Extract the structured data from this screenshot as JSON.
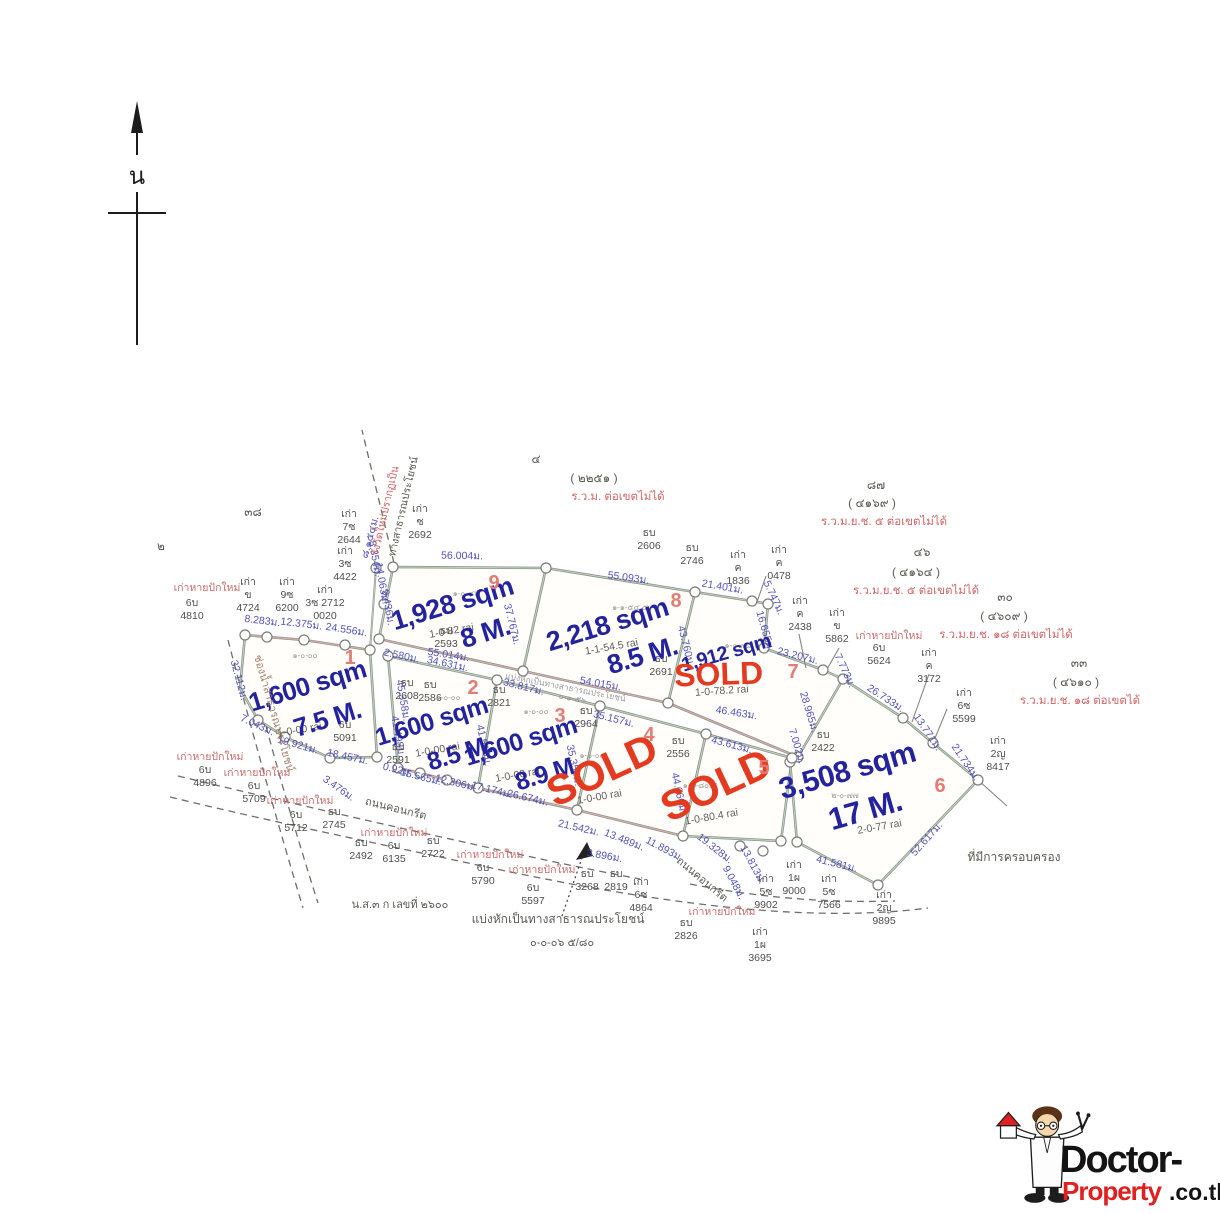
{
  "misc": {
    "compass": "น",
    "relost": "เก่าหายปักใหม่",
    "road": "ถนนคอนกรีต",
    "water": "ช่องน้ำสาธารณประโยชน์",
    "resurvey_red": "รังวัดใหม่ปรากฏเป็น",
    "resurvey_black": "ทางสาธารณประโยชน์",
    "possession": "ที่มีการครอบครอง",
    "doc": "น.ส.๓ ก เลขที่ ๒๖๐๐",
    "divide1": "แบ่งหักเป็นทางสาธารณประโยชน์",
    "divide2": "๐-๐-๐๖ ๕/๘๐",
    "road_divide": "แบ่งหักเป็นทางสาธารณประโยชน์",
    "road_divide2": "๐-๑-๕๖",
    "n38": "๓๘",
    "n2": "๒"
  },
  "colors": {
    "accent_blue": "#23239d",
    "sold_red": "#e43a20",
    "note_red": "#cf6565",
    "plot_line_green": "#b9d6ba"
  },
  "plots": [
    {
      "num": "1",
      "size": "1,600 sqm",
      "price": "7.5 M.",
      "thai": "๑-๐-๐๐",
      "rai": "1-0-00 rai"
    },
    {
      "num": "2",
      "size": "1,600 sqm",
      "price": "8.5 M.",
      "thai": "๑-๐-๐๐",
      "rai": "1-0-00 rai"
    },
    {
      "num": "3",
      "size": "1,600 sqm",
      "price": "8.9 M.",
      "thai": "๑-๐-๐๐",
      "rai": "1-0-00 rai"
    },
    {
      "num": "4",
      "sold": "SOLD",
      "thai": "๑-๐-๐๐",
      "rai": "1-0-00 rai"
    },
    {
      "num": "5",
      "sold": "SOLD",
      "thai": "๑-๐-๘๐.๔",
      "rai": "1-0-80.4 rai"
    },
    {
      "num": "6",
      "size": "3,508 sqm",
      "price": "17 M.",
      "thai": "๒-๐-๗๗",
      "rai": "2-0-77 rai"
    },
    {
      "num": "7",
      "size": "1,912 sqm",
      "sold": "SOLD",
      "thai": "๑-๐-๗๘.๒",
      "rai": "1-0-78.2 rai"
    },
    {
      "num": "8",
      "size": "2,218 sqm",
      "price": "8.5 M.",
      "thai": "๑-๑-๕๔.๕",
      "rai": "1-1-54.5 rai"
    },
    {
      "num": "9",
      "size": "1,928 sqm",
      "price": "8 M.",
      "thai": "๑-๐-๘๒",
      "rai": "1-0-82 rai"
    }
  ],
  "edges": [
    "56.004ม.",
    "55.093ม.",
    "21.401ม.",
    "5.747ม.",
    "16.655ม.",
    "23.207ม.",
    "7.773ม.",
    "26.733ม.",
    "13.771ม.",
    "21.734ม.",
    "52.617ม.",
    "41.581ม.",
    "9.048ม.",
    "13.813ม.",
    "19.328ม.",
    "11.893ม.",
    "13.489ม.",
    "21.542ม.",
    "3.896ม.",
    "46.463ม.",
    "28.965ม.",
    "7.002ม.",
    "43.613ม.",
    "44.666ม.",
    "35.157ม.",
    "35.354ม.",
    "33.817ม.",
    "41.510ม.",
    "26.674ม.",
    "17.174ม.",
    "12.306ม.",
    "15.565ม.",
    "0.92ม.",
    "18.457ม.",
    "19.921ม.",
    "7.043ม.",
    "32.112ม.",
    "8.283ม.",
    "12.375ม.",
    "24.556ม.",
    "34.631ม.",
    "2.580ม.",
    "45.358ม.",
    "41.498ม.",
    "9.436ม.",
    "14.063ม.",
    "8.354ม.",
    "54.015ม.",
    "55.014ม.",
    "37.767ม.",
    "43.760ม.",
    "3.476ม.",
    "๘.๑๕๔ม."
  ],
  "markers": [
    [
      "เก่า",
      "7ซ",
      "2644"
    ],
    [
      "เก่า",
      "ซ",
      "2692"
    ],
    [
      "เก่า",
      "3ซ",
      "4422"
    ],
    [
      "เก่า",
      "ข",
      "4724"
    ],
    [
      "เก่า",
      "9ซ",
      "6200"
    ],
    [
      "เก่า",
      "3ซ 2712",
      "0020"
    ],
    [
      "ธบ",
      "2606"
    ],
    [
      "ธบ",
      "2746"
    ],
    [
      "เก่า",
      "ค",
      "1836"
    ],
    [
      "เก่า",
      "ค",
      "0478"
    ],
    [
      "เก่า",
      "ค",
      "2438"
    ],
    [
      "เก่า",
      "ข",
      "5862"
    ],
    [
      "6บ",
      "5624"
    ],
    [
      "เก่า",
      "ค",
      "3172"
    ],
    [
      "เก่า",
      "6ซ",
      "5599"
    ],
    [
      "เก่า",
      "2ญ",
      "8417"
    ],
    [
      "ธบ",
      "2593"
    ],
    [
      "ธบ",
      "2691"
    ],
    [
      "ธบ",
      "2608"
    ],
    [
      "ธบ",
      "2586"
    ],
    [
      "ธบ",
      "2821"
    ],
    [
      "ธบ",
      "2964"
    ],
    [
      "ธบ",
      "2556"
    ],
    [
      "ธบ",
      "2422"
    ],
    [
      "6บ",
      "5091"
    ],
    [
      "ธบ",
      "2591"
    ],
    [
      "6บ",
      "4810"
    ],
    [
      "6บ",
      "4896"
    ],
    [
      "6บ",
      "5709"
    ],
    [
      "6บ",
      "5712"
    ],
    [
      "ธบ",
      "2745"
    ],
    [
      "ธบ",
      "2492"
    ],
    [
      "6บ",
      "6135"
    ],
    [
      "ธบ",
      "2722"
    ],
    [
      "6บ",
      "5790"
    ],
    [
      "6บ",
      "5597"
    ],
    [
      "ธบ",
      "3268"
    ],
    [
      "ธบ",
      "2819"
    ],
    [
      "เก่า",
      "6ซ",
      "4864"
    ],
    [
      "ธบ",
      "2826"
    ],
    [
      "เก่า",
      "1ผ",
      "3695"
    ],
    [
      "เก่า",
      "5ซ",
      "9902"
    ],
    [
      "เก่า",
      "1ผ",
      "9000"
    ],
    [
      "เก่า",
      "5ซ",
      "7566"
    ],
    [
      "เก่า",
      "2ญ",
      "9895"
    ]
  ],
  "notes": [
    {
      "num": "๔",
      "code": "( ๒๒๕๑ )",
      "text": "ร.ว.ม. ต่อเขตไม่ได้"
    },
    {
      "num": "๘๗",
      "code": "( ๔๑๖๙ )",
      "text": "ร.ว.ม.ย.ช. ๕ ต่อเขตไม่ได้"
    },
    {
      "num": "๔๖",
      "code": "( ๔๑๖๔ )",
      "text": "ร.ว.ม.ย.ช. ๕ ต่อเขตไม่ได้"
    },
    {
      "num": "๓๐",
      "code": "( ๔๖๐๙ )",
      "text": "ร.ว.ม.ย.ช. ๑๘ ต่อเขตไม่ได้"
    },
    {
      "num": "๓๓",
      "code": "( ๔๖๑๐ )",
      "text": "ร.ว.ม.ย.ช. ๑๘ ต่อเขตได้"
    }
  ],
  "logo": {
    "brand1": "Doctor-",
    "brand2": "Property",
    "brand3": ".co.th"
  }
}
